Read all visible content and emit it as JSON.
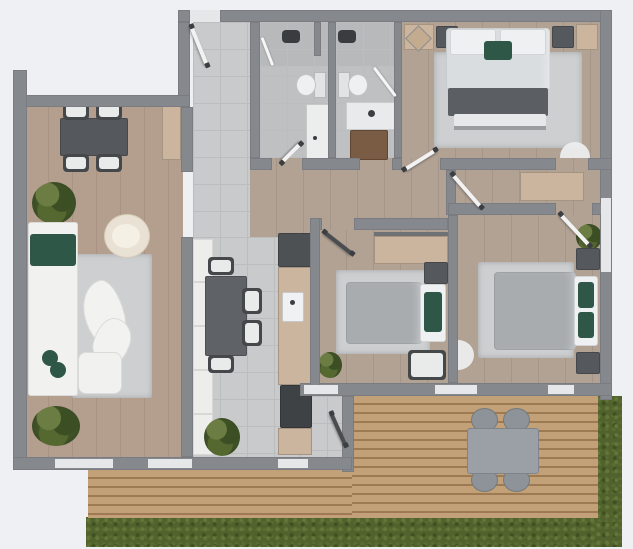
{
  "image_type": "3d-apartment-floor-plan-top-view",
  "visible_text": [],
  "palette": {
    "background": "#eef0f3",
    "wall": "#85888c",
    "wood_living": "#b19b8b",
    "wood_bedroom": "#b1a093",
    "tile": "#c9cacb",
    "deck_wood": "#c3a178",
    "grass": "#51622c",
    "furniture_dark": "#55585c",
    "furniture_beige": "#ccb59e",
    "accent_green": "#2e5748",
    "rug": "#cdcfd1",
    "sofa_white": "#f1f1ef",
    "bed_gray": "#a8acaf",
    "bed_light": "#dadde0",
    "vanity_brown": "#7a5c44",
    "door_white": "#f2f2f2",
    "outdoor_gray": "#9aa0a5",
    "plant_green": "#4a5c2a"
  },
  "rooms": [
    {
      "name": "Living room",
      "floor": "wood",
      "furniture": [
        "corner sofa with green cushions",
        "round cream armchair",
        "organic-shape coffee tables",
        "ottoman",
        "area rug",
        "potted plant (upper)",
        "potted plant (lower)"
      ]
    },
    {
      "name": "Dining area",
      "floor": "wood",
      "furniture": [
        "rectangular dining table",
        "4 chairs",
        "beige sideboard",
        "potted plant"
      ]
    },
    {
      "name": "Entrance hall",
      "floor": "tile",
      "furniture": [
        "entry door"
      ]
    },
    {
      "name": "Bathroom 1",
      "floor": "tile",
      "furniture": [
        "shower with glass door",
        "toilet",
        "washer / vanity column"
      ]
    },
    {
      "name": "Bathroom 2",
      "floor": "tile",
      "furniture": [
        "shower with glass door",
        "toilet",
        "basin counter",
        "brown vanity cabinet"
      ]
    },
    {
      "name": "Main bedroom",
      "floor": "wood",
      "furniture": [
        "double bed with green cushion",
        "2 dark nightstands",
        "2 beige wardrobes",
        "decor cushion",
        "foot bench",
        "area rug"
      ]
    },
    {
      "name": "Kitchen / dining",
      "floor": "tile",
      "furniture": [
        "tall fridge cabinet",
        "counter with sink",
        "cooktop",
        "white cabinet row",
        "dining table",
        "4 chairs",
        "potted plant"
      ]
    },
    {
      "name": "Bedroom 2",
      "floor": "wood",
      "furniture": [
        "single bed with green pillow",
        "nightstand",
        "beige wardrobe",
        "chair",
        "area rug",
        "potted plant"
      ]
    },
    {
      "name": "Bedroom 3",
      "floor": "wood",
      "furniture": [
        "double bed with green pillows",
        "2 nightstands",
        "area rug",
        "potted plant"
      ]
    },
    {
      "name": "Hallway",
      "floor": "wood",
      "furniture": [
        "beige sideboard"
      ]
    },
    {
      "name": "Terrace deck",
      "floor": "deck",
      "furniture": [
        "outdoor table",
        "4 outdoor chairs"
      ]
    },
    {
      "name": "Garden",
      "floor": "grass",
      "furniture": []
    }
  ],
  "doors": [
    "entry door",
    "bathroom-1 door",
    "bathroom-2 door",
    "main-bedroom door",
    "hall-corridor door",
    "bedroom-2 door",
    "bedroom-3 door",
    "deck door",
    "main-bedroom arc",
    "bedroom-3 arc"
  ],
  "windows": [
    "living-room window left",
    "living-room window right",
    "kitchen window",
    "right-wall window",
    "deck threshold 1",
    "deck threshold 2",
    "kitchen threshold"
  ]
}
